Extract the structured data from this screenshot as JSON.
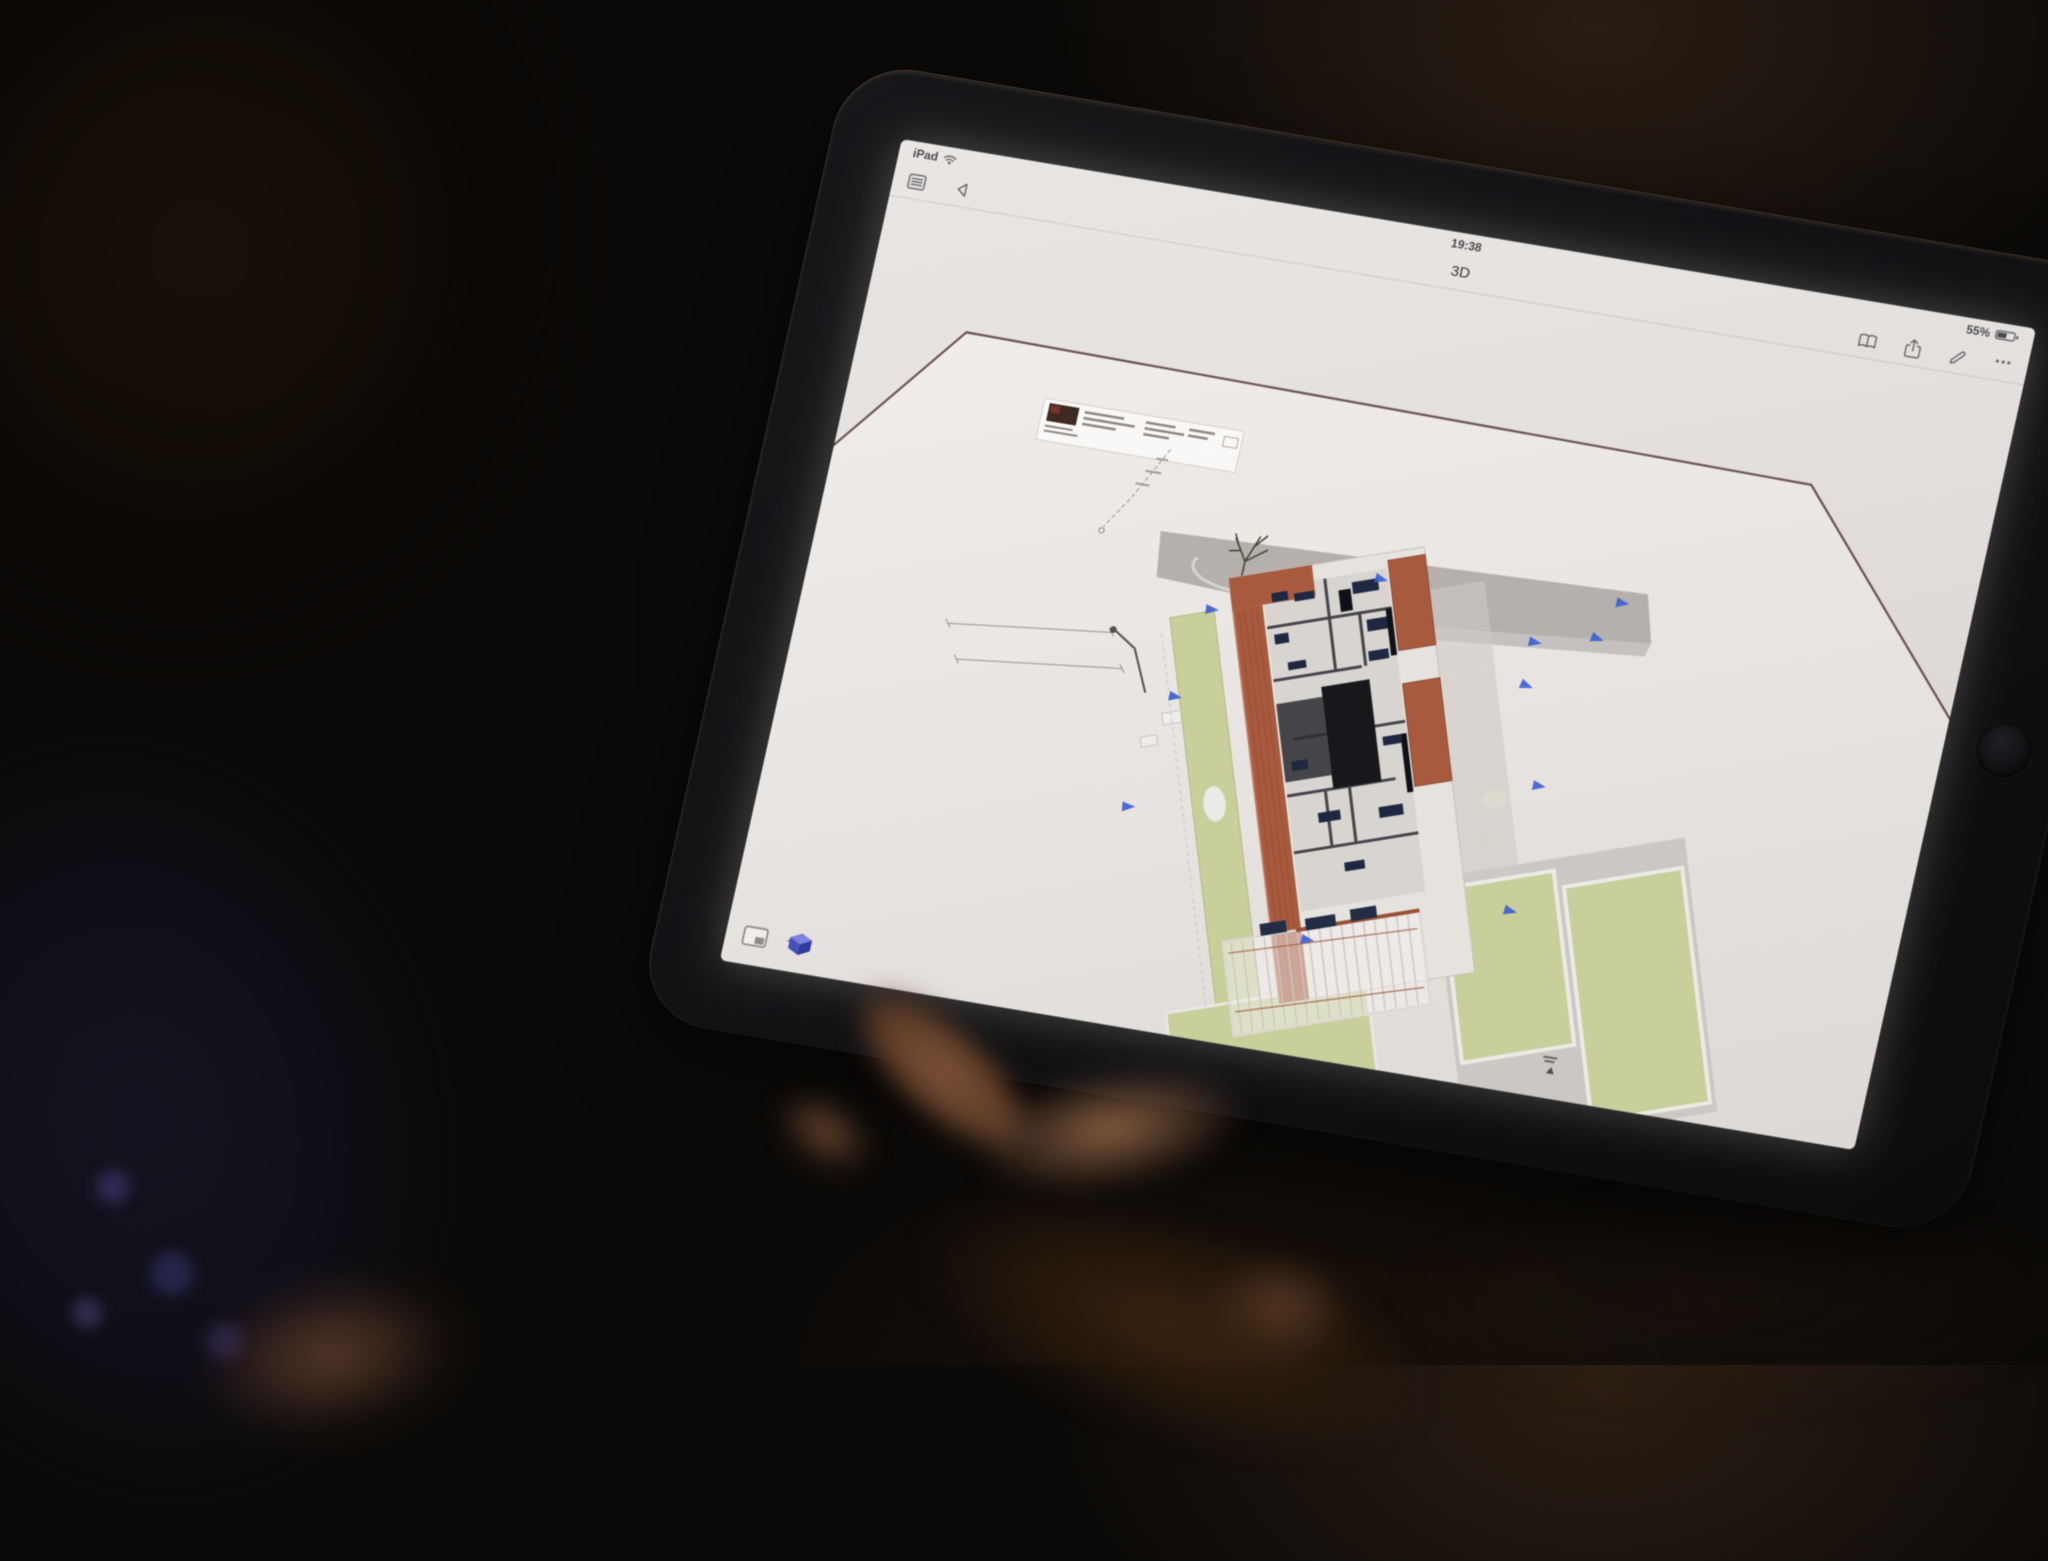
{
  "device": {
    "status_bar": {
      "carrier": "iPad",
      "time": "19:38",
      "battery_percent": "55%"
    },
    "nav_bar": {
      "title": "3D",
      "more_glyph": "•••"
    }
  },
  "icons": {
    "status_left": [
      "wifi-icon"
    ],
    "status_right": [
      "battery-icon"
    ],
    "nav_left": [
      "sheet-list-icon",
      "back-icon"
    ],
    "nav_right": [
      "book-icon",
      "share-icon",
      "markup-pencil-icon",
      "more-ellipsis-icon"
    ],
    "viewer_toolbar": [
      "sheet-view-icon",
      "model-view-3d-icon"
    ],
    "model_markers": "viewpoint-marker"
  },
  "colors": {
    "accent-blue": "#3e5fd4",
    "roof-red": "#a85a3f",
    "roof-red-dark": "#8d4731",
    "lawn-green": "#c9cf9b",
    "sidewalk-gray": "#b5b0ab",
    "border-maroon": "#6a5150",
    "screen-white": "#ece8e5",
    "bezel-black": "#121214",
    "status-text": "#4a4a4c",
    "icon-gray": "#6b6b6d"
  }
}
